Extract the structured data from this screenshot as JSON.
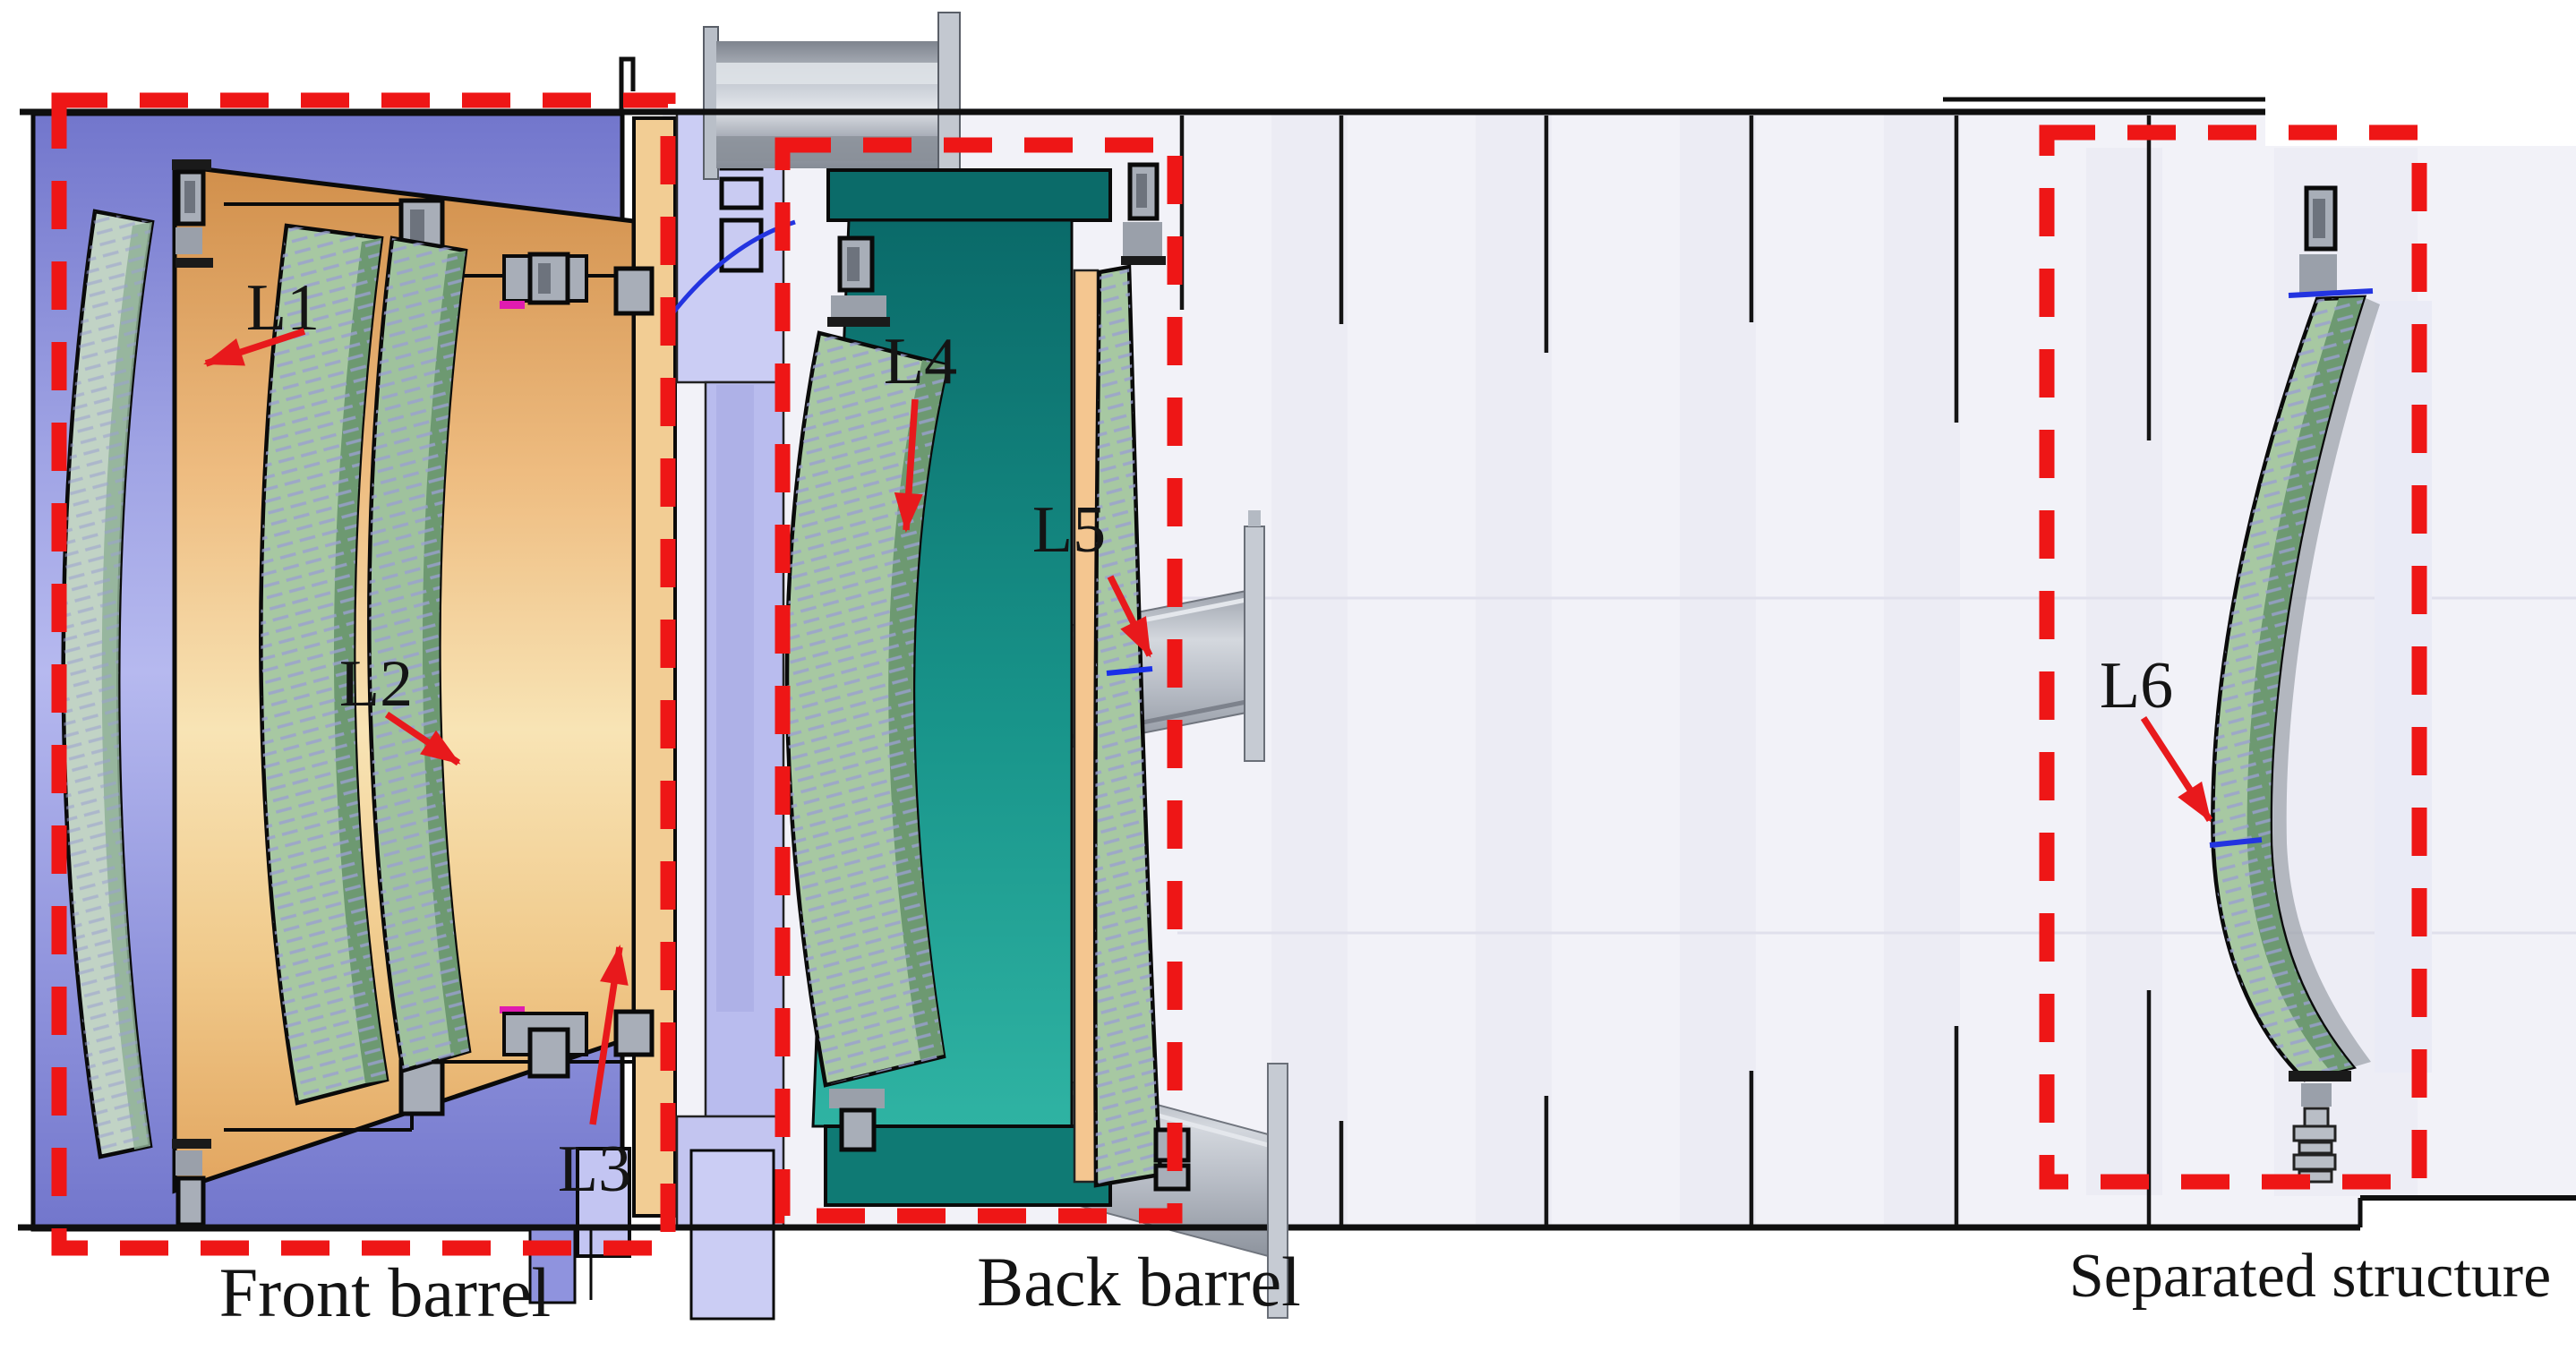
{
  "figure": {
    "type": "engineering-cad-cross-section",
    "description": "Cross-section CAD drawing of a six-lens optical telescope assembly showing front barrel, back barrel and separated lens structure",
    "section_labels": {
      "front_barrel": "Front barrel",
      "back_barrel": "Back barrel",
      "separated_structure": "Separated structure"
    },
    "lens_labels": {
      "l1": "L1",
      "l2": "L2",
      "l3": "L3",
      "l4": "L4",
      "l5": "L5",
      "l6": "L6"
    },
    "colors": {
      "highlight_box_red": "#ee1616",
      "arrow_red": "#e8191c",
      "front_housing_purple": "#8286d8",
      "lens_cone_orange": "#eec286",
      "lens_green": "#a7c8a2",
      "lens_green_dark": "#6d9971",
      "back_barrel_teal": "#18948a",
      "connector_lavender": "#cbcdf4",
      "metal_gray": "#b4bac3",
      "tube_background": "#f2f2f8",
      "ray_blue": "#2334e0"
    }
  }
}
